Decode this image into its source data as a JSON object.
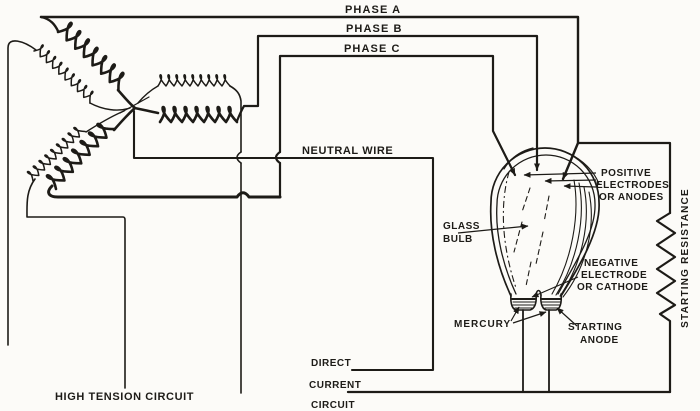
{
  "figure": {
    "colors": {
      "ink": "#1d1b17",
      "paper": "#fcfbf8"
    },
    "labels": {
      "phase_a": "PHASE A",
      "phase_b": "PHASE B",
      "phase_c": "PHASE C",
      "neutral_wire": "NEUTRAL WIRE",
      "glass_bulb": [
        "GLASS",
        "BULB"
      ],
      "positive_electrodes": [
        "POSITIVE",
        "ELECTRODES",
        "OR ANODES"
      ],
      "negative_electrode": [
        "NEGATIVE",
        "ELECTRODE",
        "OR CATHODE"
      ],
      "mercury": "MERCURY",
      "starting_anode": [
        "STARTING",
        "ANODE"
      ],
      "starting_resistance": "STARTING  RESISTANCE",
      "high_tension_circuit": "HIGH TENSION CIRCUIT",
      "direct_current_circuit": [
        "DIRECT",
        "CURRENT",
        "CIRCUIT"
      ]
    }
  }
}
